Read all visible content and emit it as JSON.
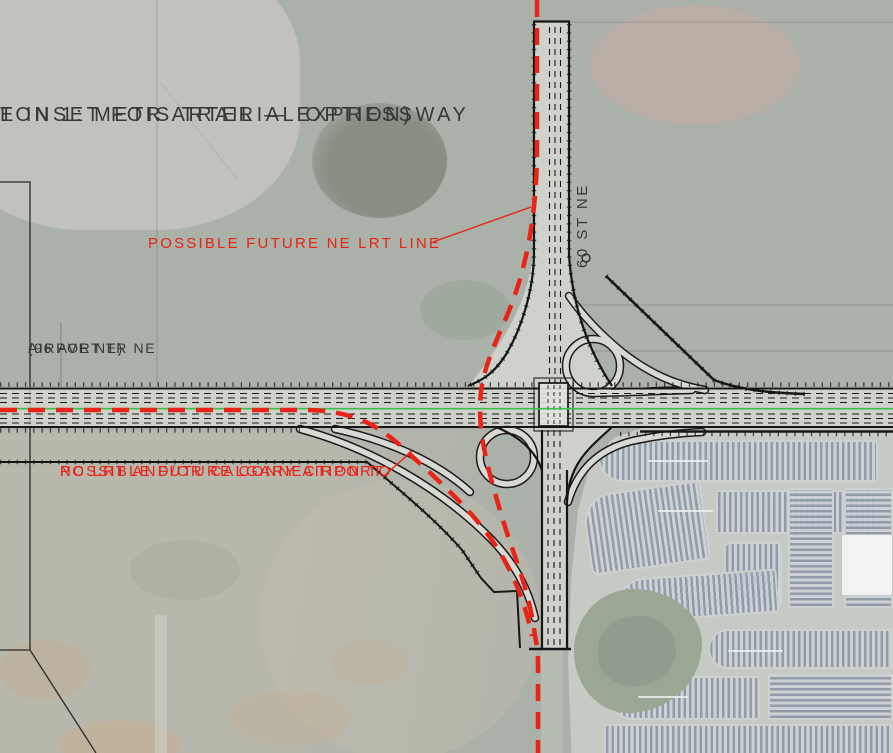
{
  "map": {
    "title_line1": "TON 1: METIS TRAIL — EXPRESSWAY",
    "title_line2": "E INSET FOR ARTERIAL OPTION)",
    "annotations": {
      "lrt_line": "POSSIBLE FUTURE NE LRT LINE",
      "connection_line1": "POSSIBLE FUTURE CONNECTION TO",
      "connection_line2": "NC LRT AND/OR CALGARY AIRPORT"
    },
    "road_labels": {
      "airport_trail_line1": "AIRPORT TR NE",
      "airport_trail_line2": "(96 AVE NE)",
      "street_60": "60 ST NE"
    },
    "colors": {
      "annotation_red": "#e82318",
      "median_green": "#3fbf49",
      "road_edge_black": "#1c1c1c",
      "aerial_base": "#aab1a8"
    }
  }
}
